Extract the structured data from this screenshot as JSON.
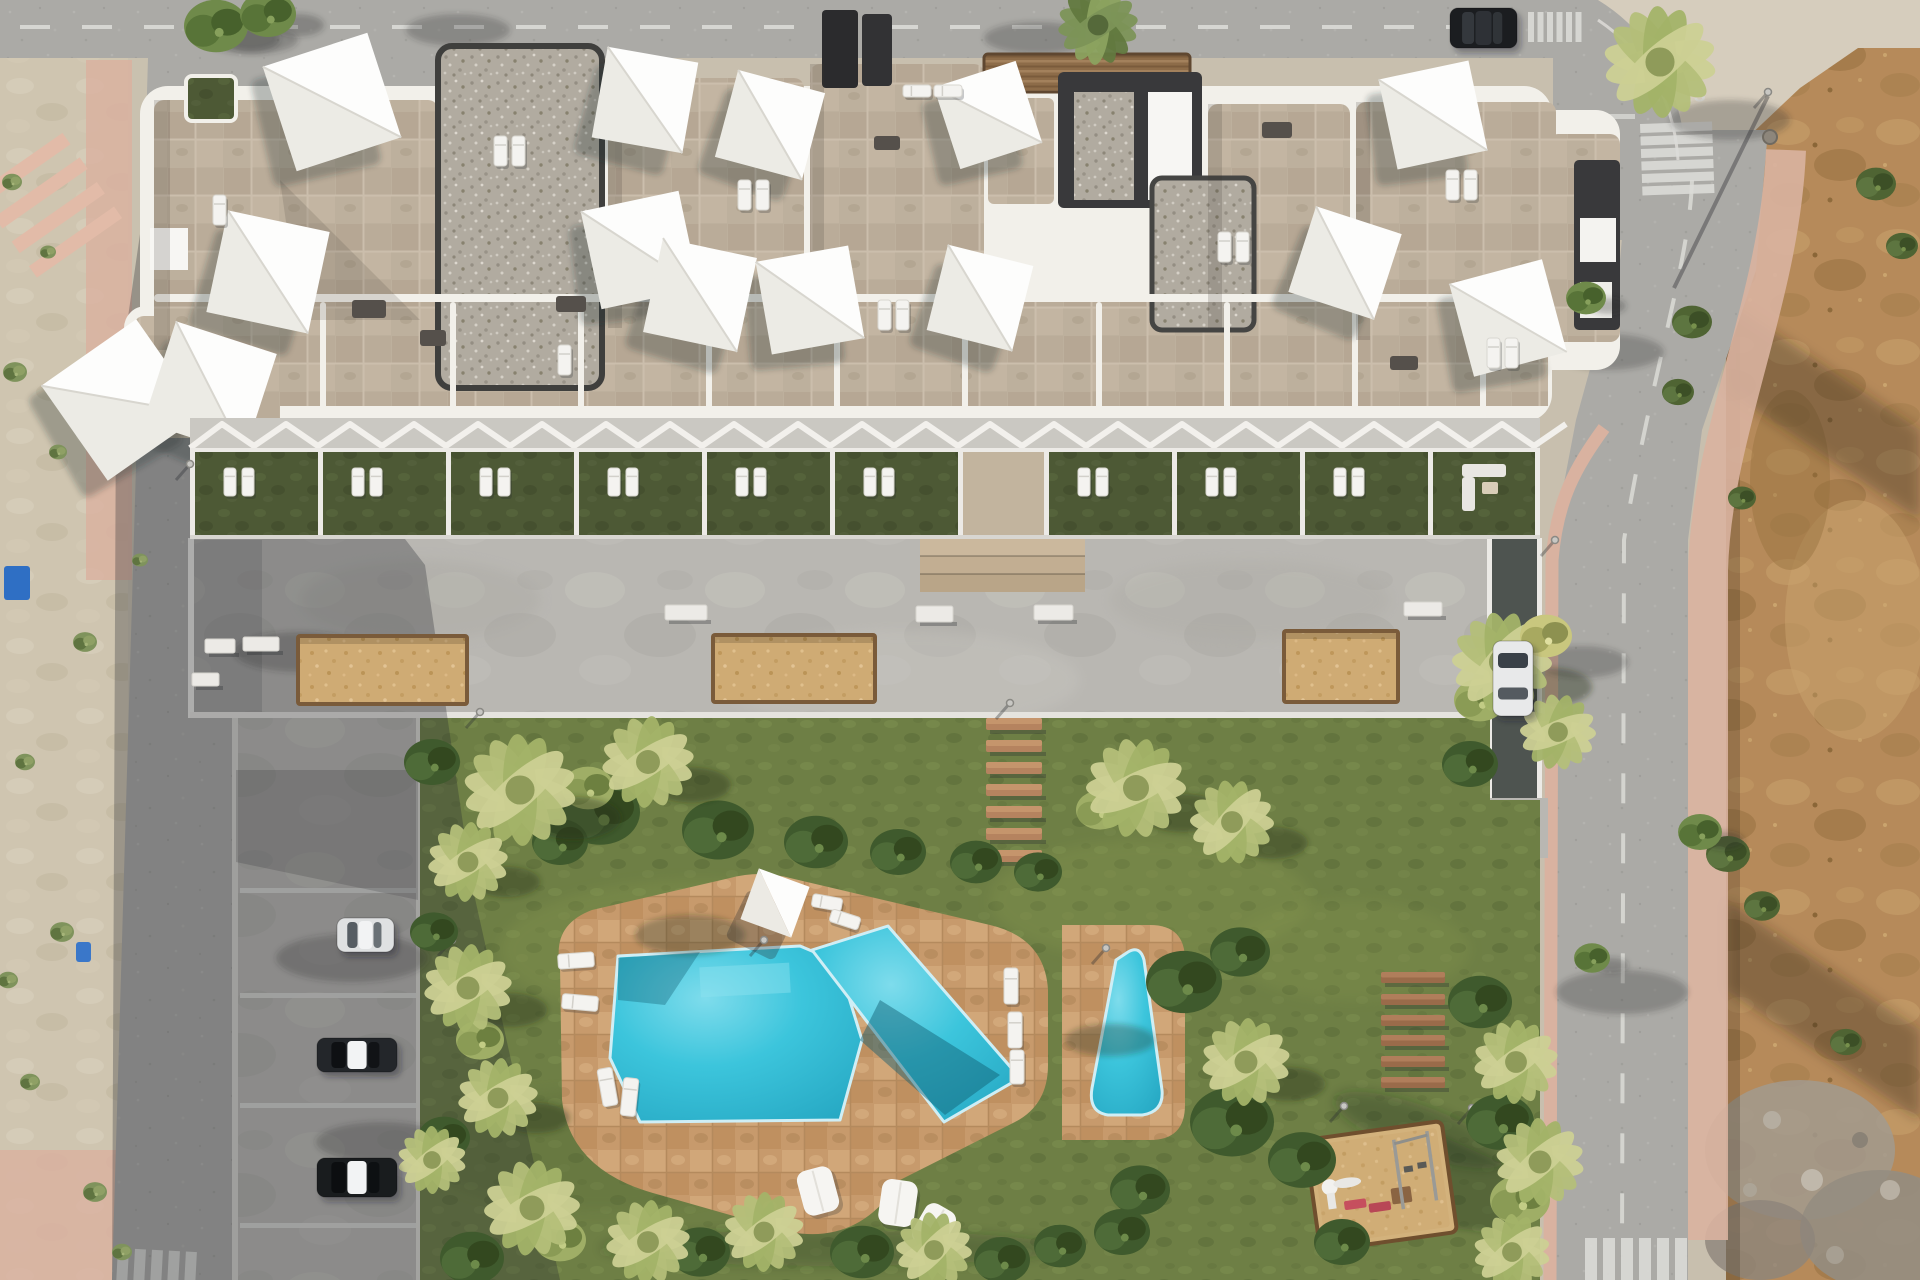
{
  "scene": {
    "description": "Aerial top-down 3D architectural render of a white residential apartment block with rooftop terraces and shade sails, a communal garden with free-form swimming pool, a small secondary pool, playground, wooden benches, resident parking, and surrounding streets with an undeveloped dirt lot on the right",
    "type": "architectural-render"
  },
  "road_markings": {
    "stop_text": "STOP"
  },
  "palette": {
    "asphalt": "#abaaa6",
    "asphalt_light": "#b6b4b0",
    "concrete": "#b9b7b2",
    "plaza": "#bbb9b4",
    "stone_roof": "#bdb09d",
    "gravel": "#b1aba0",
    "parapet_white": "#f2f0ea",
    "core_dark": "#39393b",
    "lawn": "#6e7f45",
    "terrace_lawn": "#4d5935",
    "pool_water": "#3cc5dc",
    "deck_tan": "#c79a6c",
    "planter_sand": "#cfab74",
    "dirt": "#b68a5a",
    "sidewalk_pink": "#d9b2a0",
    "sidewalk_pale": "#d6cdbd",
    "wood": "#9a6b4a",
    "shadow": "rgba(38,40,46,0.30)"
  },
  "building": {
    "shade_sails": [
      [
        332,
        102,
        110,
        -18
      ],
      [
        268,
        272,
        104,
        12
      ],
      [
        122,
        400,
        116,
        -35
      ],
      [
        210,
        388,
        106,
        18
      ],
      [
        645,
        100,
        92,
        10
      ],
      [
        640,
        250,
        100,
        -12
      ],
      [
        770,
        125,
        90,
        15
      ],
      [
        988,
        115,
        86,
        -18
      ],
      [
        700,
        295,
        96,
        12
      ],
      [
        810,
        300,
        94,
        -10
      ],
      [
        980,
        298,
        88,
        14
      ],
      [
        1433,
        115,
        92,
        -12
      ],
      [
        1345,
        263,
        90,
        18
      ],
      [
        1508,
        318,
        96,
        -15
      ]
    ],
    "roof_loungers": [
      [
        494,
        136,
        13,
        30
      ],
      [
        512,
        136,
        13,
        30
      ],
      [
        213,
        195,
        13,
        30
      ],
      [
        878,
        300,
        13,
        30
      ],
      [
        896,
        300,
        13,
        30
      ],
      [
        1218,
        232,
        13,
        30
      ],
      [
        1236,
        232,
        13,
        30
      ],
      [
        1446,
        170,
        13,
        30
      ],
      [
        1464,
        170,
        13,
        30
      ],
      [
        1487,
        338,
        13,
        30
      ],
      [
        1505,
        338,
        13,
        30
      ],
      [
        903,
        85,
        28,
        12
      ],
      [
        934,
        85,
        28,
        12
      ],
      [
        738,
        180,
        13,
        30
      ],
      [
        756,
        180,
        13,
        30
      ],
      [
        558,
        345,
        13,
        30
      ]
    ],
    "dark_furniture": [
      [
        556,
        296,
        30,
        16
      ],
      [
        874,
        136,
        26,
        14
      ],
      [
        1262,
        122,
        30,
        16
      ],
      [
        1390,
        356,
        28,
        14
      ],
      [
        352,
        300,
        34,
        18
      ],
      [
        420,
        330,
        26,
        16
      ]
    ],
    "terraces": {
      "wall_xs": [
        190,
        318,
        446,
        574,
        702,
        830,
        958,
        1044,
        1172,
        1300,
        1428,
        1535
      ],
      "lounger_bays": [
        190,
        318,
        446,
        574,
        702,
        830,
        1044,
        1172,
        1300
      ],
      "corridor_x": 958,
      "corridor_w": 86,
      "sofa_bay_x": 1428
    }
  },
  "plaza": {
    "planters": [
      [
        300,
        638,
        165,
        64
      ],
      [
        715,
        637,
        158,
        63
      ],
      [
        1286,
        633,
        110,
        67
      ]
    ],
    "benches": [
      [
        665,
        605,
        42,
        15
      ],
      [
        916,
        606,
        37,
        16
      ],
      [
        1034,
        605,
        39,
        15
      ],
      [
        205,
        639,
        30,
        14
      ],
      [
        243,
        637,
        36,
        14
      ],
      [
        192,
        673,
        27,
        13
      ],
      [
        1404,
        602,
        38,
        14
      ]
    ],
    "step_planks": {
      "x": 986,
      "w": 56,
      "h": 12,
      "ys": [
        718,
        740,
        762,
        784,
        806,
        828,
        850
      ]
    }
  },
  "garden": {
    "wood_benches": {
      "x": 1381,
      "w": 64,
      "h": 11,
      "ys": [
        972,
        994,
        1015,
        1035,
        1056,
        1077
      ]
    },
    "pool_loungers": [
      [
        812,
        896,
        30,
        13,
        10
      ],
      [
        830,
        913,
        30,
        13,
        18
      ],
      [
        558,
        953,
        36,
        15,
        -4
      ],
      [
        562,
        995,
        36,
        15,
        5
      ],
      [
        600,
        1068,
        15,
        38,
        -10
      ],
      [
        622,
        1078,
        15,
        38,
        6
      ],
      [
        1004,
        968,
        14,
        36,
        0
      ],
      [
        1008,
        1012,
        14,
        36,
        0
      ],
      [
        1010,
        1050,
        14,
        34,
        0
      ]
    ],
    "bean_bags": [
      [
        800,
        1168,
        36,
        46,
        -15
      ],
      [
        880,
        1180,
        36,
        46,
        8
      ],
      [
        917,
        1205,
        34,
        44,
        30
      ]
    ],
    "parasol": {
      "x": 775,
      "y": 903,
      "size": 54,
      "rot": 20
    }
  },
  "parking": {
    "stall_ys": [
      888,
      993,
      1103,
      1223
    ],
    "cars": [
      {
        "x": 337,
        "y": 918,
        "w": 57,
        "h": 34,
        "body": "#dfe1e2",
        "glass": "#565d63"
      },
      {
        "x": 317,
        "y": 1038,
        "w": 80,
        "h": 34,
        "body": "#23262a",
        "glass": "#0e1013"
      },
      {
        "x": 317,
        "y": 1158,
        "w": 80,
        "h": 39,
        "body": "#191c1e",
        "glass": "#0c0e10"
      }
    ]
  },
  "streets": {
    "cars": [
      {
        "x": 1450,
        "y": 8,
        "w": 67,
        "h": 40,
        "body": "#1b1d20",
        "glass": "#34383d"
      },
      {
        "x": 1493,
        "y": 641,
        "w": 40,
        "h": 75,
        "body": "#e8e9ea",
        "glass": "#3a4148"
      }
    ],
    "crosswalks": [
      {
        "x": 203,
        "y": 112,
        "w": 21,
        "h": 62,
        "n": 7,
        "dx": 33,
        "dy": 0,
        "rot": -2
      },
      {
        "x": 1528,
        "y": 12,
        "w": 6,
        "h": 30,
        "n": 6,
        "dx": 9.5,
        "dy": 0,
        "rot": 0
      },
      {
        "x": 1640,
        "y": 124,
        "w": 72,
        "h": 9,
        "n": 6,
        "dx": 0,
        "dy": 12.5,
        "rot": -2
      },
      {
        "x": 1585,
        "y": 1238,
        "w": 12,
        "h": 42,
        "n": 6,
        "dx": 18,
        "dy": 0,
        "rot": 0
      },
      {
        "x": 118,
        "y": 1248,
        "w": 11,
        "h": 32,
        "n": 5,
        "dx": 17,
        "dy": 0,
        "rot": 3
      }
    ],
    "lamps": [
      [
        480,
        712
      ],
      [
        1010,
        703
      ],
      [
        452,
        940
      ],
      [
        764,
        940
      ],
      [
        1106,
        948
      ],
      [
        1344,
        1106
      ],
      [
        1472,
        1108
      ],
      [
        190,
        464
      ],
      [
        1555,
        540
      ],
      [
        1556,
        1142
      ],
      [
        1768,
        92
      ]
    ],
    "bins": [
      [
        4,
        566,
        26,
        34,
        "#2f6fc4"
      ],
      [
        76,
        942,
        15,
        20,
        "#3a77c9"
      ]
    ]
  },
  "vegetation": {
    "palms": [
      [
        520,
        790,
        56,
        1
      ],
      [
        648,
        762,
        46,
        1
      ],
      [
        468,
        862,
        40,
        1
      ],
      [
        1136,
        788,
        50,
        1
      ],
      [
        1232,
        822,
        42,
        1
      ],
      [
        468,
        988,
        44,
        1
      ],
      [
        498,
        1098,
        40,
        1
      ],
      [
        532,
        1208,
        48,
        0
      ],
      [
        648,
        1242,
        42,
        0
      ],
      [
        764,
        1232,
        40,
        0
      ],
      [
        934,
        1250,
        38,
        0
      ],
      [
        1246,
        1062,
        44,
        1
      ],
      [
        1502,
        662,
        50,
        1
      ],
      [
        1558,
        732,
        38,
        0
      ],
      [
        1516,
        1062,
        42,
        0
      ],
      [
        1540,
        1162,
        44,
        0
      ],
      [
        1512,
        1252,
        38,
        0
      ],
      [
        1660,
        62,
        56,
        0
      ],
      [
        432,
        1160,
        34,
        0
      ],
      [
        1098,
        25,
        40,
        0
      ]
    ],
    "bushes": [
      [
        600,
        812,
        40
      ],
      [
        718,
        830,
        36
      ],
      [
        816,
        842,
        32
      ],
      [
        898,
        852,
        28
      ],
      [
        976,
        862,
        26
      ],
      [
        1038,
        872,
        24
      ],
      [
        560,
        842,
        28
      ],
      [
        1184,
        982,
        38
      ],
      [
        1232,
        1122,
        42
      ],
      [
        1302,
        1160,
        34
      ],
      [
        432,
        762,
        28
      ],
      [
        444,
        1138,
        26
      ],
      [
        472,
        1258,
        32
      ],
      [
        700,
        1252,
        30
      ],
      [
        862,
        1252,
        32
      ],
      [
        1002,
        1260,
        28
      ],
      [
        1122,
        1232,
        28
      ],
      [
        1342,
        1242,
        28
      ],
      [
        1480,
        1002,
        32
      ],
      [
        1500,
        1122,
        34
      ],
      [
        1470,
        764,
        28
      ],
      [
        434,
        932,
        24
      ],
      [
        1240,
        952,
        30
      ],
      [
        1140,
        1190,
        30
      ],
      [
        1060,
        1246,
        26
      ]
    ],
    "yellow_bushes": [
      [
        588,
        788,
        26
      ],
      [
        1100,
        810,
        24
      ],
      [
        1480,
        700,
        26
      ],
      [
        1520,
        1200,
        30
      ],
      [
        480,
        1040,
        24
      ],
      [
        560,
        1240,
        26
      ]
    ],
    "weeds_dirt": [
      [
        1692,
        322,
        20
      ],
      [
        1678,
        392,
        16
      ],
      [
        1728,
        854,
        22
      ],
      [
        1762,
        906,
        18
      ],
      [
        1876,
        184,
        20
      ],
      [
        1902,
        246,
        16
      ],
      [
        1846,
        1042,
        16
      ],
      [
        1742,
        498,
        14
      ]
    ],
    "grass_tufts": [
      [
        15,
        372,
        12
      ],
      [
        58,
        452,
        9
      ],
      [
        85,
        642,
        12
      ],
      [
        25,
        762,
        10
      ],
      [
        62,
        932,
        12
      ],
      [
        30,
        1082,
        10
      ],
      [
        95,
        1192,
        12
      ],
      [
        122,
        1252,
        10
      ],
      [
        12,
        182,
        10
      ],
      [
        48,
        252,
        8
      ],
      [
        140,
        560,
        8
      ],
      [
        8,
        980,
        10
      ]
    ],
    "street_trees": [
      [
        216,
        26,
        32
      ],
      [
        268,
        14,
        28
      ],
      [
        1586,
        298,
        20
      ],
      [
        1700,
        832,
        22
      ],
      [
        1592,
        958,
        18
      ]
    ],
    "yellow_trees": [
      [
        1546,
        636,
        26
      ]
    ],
    "road_tree_shadows": [
      [
        300,
        652,
        66,
        20
      ],
      [
        352,
        958,
        76,
        24
      ],
      [
        382,
        1142,
        66,
        20
      ],
      [
        458,
        30,
        52,
        16
      ],
      [
        252,
        40,
        46,
        14
      ],
      [
        1608,
        352,
        56,
        18
      ],
      [
        1622,
        992,
        66,
        22
      ],
      [
        1582,
        662,
        46,
        16
      ],
      [
        1038,
        38,
        54,
        16
      ],
      [
        1730,
        120,
        60,
        20
      ]
    ]
  }
}
